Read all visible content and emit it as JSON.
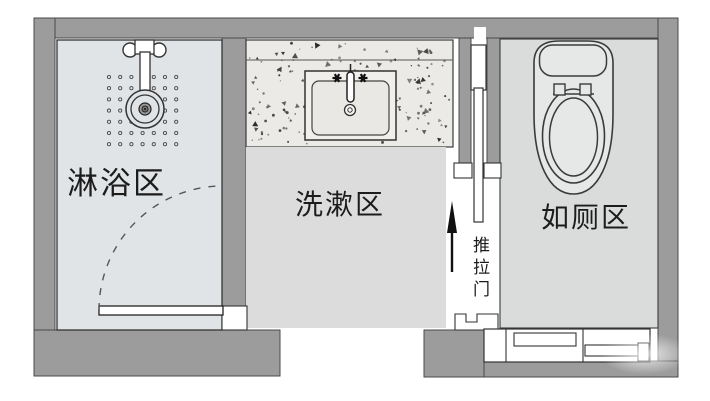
{
  "colors": {
    "wall": "#9c9c9c",
    "wall_outline": "#4a4a4a",
    "shower_floor": "#e0e4e6",
    "washing_floor": "#dcdcdc",
    "toilet_floor": "#dadcdc",
    "counter_surface": "#eceae6",
    "fixture_line": "#333333",
    "label_text": "#1c1c1c"
  },
  "zones": {
    "shower": {
      "label": "淋浴区",
      "fixture_icon": "shower-head-icon"
    },
    "washing": {
      "label": "洗漱区",
      "fixture_icon": "sink-icon"
    },
    "toilet": {
      "label": "如厕区",
      "fixture_icon": "toilet-icon"
    }
  },
  "annotations": {
    "sliding_door_label": "推拉门",
    "entry_arrow_icon": "arrow-up-icon",
    "swing_door_icon": "door-swing-arc-icon",
    "cabinet_icon": "cabinet-icon"
  }
}
